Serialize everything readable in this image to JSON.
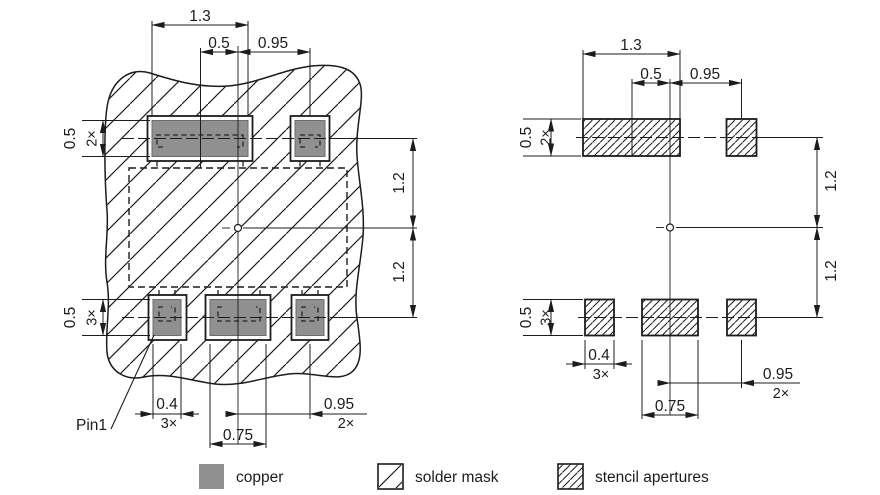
{
  "drawing_title": "package footprint land pattern drawing",
  "colors": {
    "copper": "#909090",
    "line": "#1c1c1c",
    "background": "#ffffff"
  },
  "legend": {
    "copper_label": "copper",
    "solder_mask_label": "solder mask",
    "stencil_label": "stencil apertures"
  },
  "left_view": {
    "description": "copper pads with solder mask",
    "pin1_label": "Pin1",
    "dims": {
      "top_width": "1.3",
      "top_center_offset": "0.5",
      "top_right_offset": "0.95",
      "pad_height_top": "0.5",
      "pad_height_top_count": "2×",
      "vertical_upper": "1.2",
      "vertical_lower": "1.2",
      "pad_height_bottom": "0.5",
      "pad_height_bottom_count": "3×",
      "pad_width_bottom": "0.4",
      "pad_width_bottom_count": "3×",
      "center_pad_width": "0.75",
      "right_offset_bottom": "0.95",
      "right_offset_bottom_count": "2×"
    }
  },
  "right_view": {
    "description": "stencil apertures",
    "dims": {
      "top_width": "1.3",
      "top_center_offset": "0.5",
      "top_right_offset": "0.95",
      "pad_height_top": "0.5",
      "pad_height_top_count": "2×",
      "vertical_upper": "1.2",
      "vertical_lower": "1.2",
      "pad_height_bottom": "0.5",
      "pad_height_bottom_count": "3×",
      "pad_width_bottom": "0.4",
      "pad_width_bottom_count": "3×",
      "center_pad_width": "0.75",
      "right_offset_bottom": "0.95",
      "right_offset_bottom_count": "2×"
    }
  }
}
